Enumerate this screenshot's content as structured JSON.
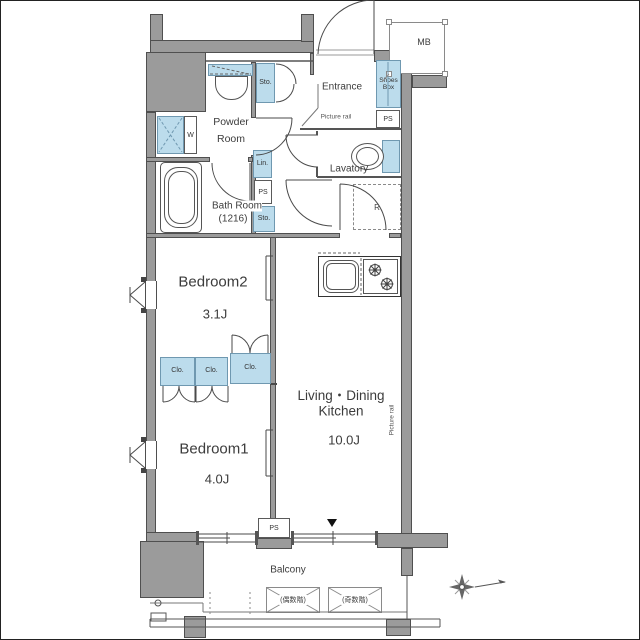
{
  "colors": {
    "wall": "#9b9b9b",
    "fixture_blue": "#bcdcec",
    "line": "#4a4a4a"
  },
  "rooms": {
    "entrance": {
      "name": "Entrance"
    },
    "powder": {
      "l1": "Powder",
      "l2": "Room"
    },
    "bath": {
      "l1": "Bath Room",
      "l2": "(1216)"
    },
    "lavatory": {
      "name": "Lavatory"
    },
    "bedroom2": {
      "name": "Bedroom2",
      "size": "3.1J"
    },
    "bedroom1": {
      "name": "Bedroom1",
      "size": "4.0J"
    },
    "ldk": {
      "l1": "Living・Dining",
      "l2": "Kitchen",
      "size": "10.0J"
    },
    "balcony": {
      "name": "Balcony"
    }
  },
  "fixtures": {
    "mb": "MB",
    "ps": "PS",
    "shoes1": "Shoes",
    "shoes2": "Box",
    "sto": "Sto.",
    "lin": "Lin.",
    "clo": "Clo.",
    "washer": "W",
    "fridge": "R",
    "picture_rail": "Picture rail"
  },
  "balcony_marks": {
    "even": "(偶数階)",
    "odd": "(奇数階)"
  }
}
